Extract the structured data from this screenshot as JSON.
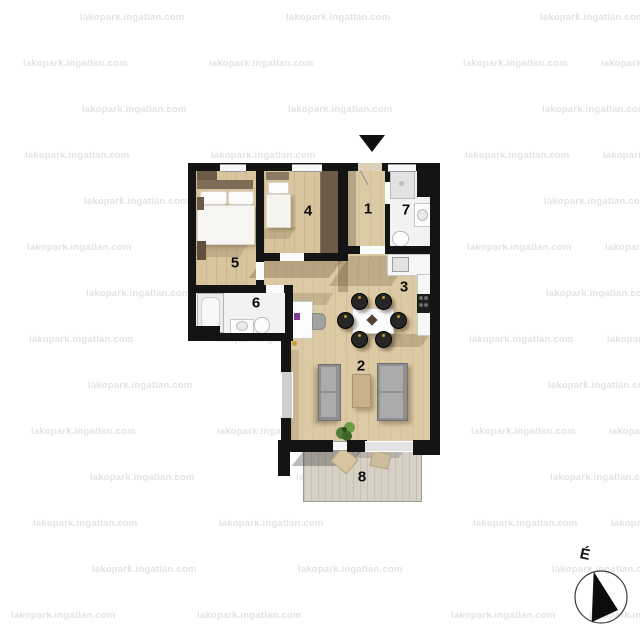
{
  "watermark": {
    "text": "lakopark.ingatlan.com"
  },
  "compass": {
    "north_label": "É"
  },
  "rooms": {
    "r1": {
      "label": "1"
    },
    "r2": {
      "label": "2"
    },
    "r3": {
      "label": "3"
    },
    "r4": {
      "label": "4"
    },
    "r5": {
      "label": "5"
    },
    "r6": {
      "label": "6"
    },
    "r7": {
      "label": "7"
    },
    "r8": {
      "label": "8"
    }
  },
  "palette": {
    "wall": "#141414",
    "wood": "#dccaa4",
    "wood2": "#d8c59e",
    "bath": "#f2f2f2",
    "terrace": "#d7d0c5",
    "sofa": "#8f8f8f",
    "wardrobe": "#6b5b48",
    "gold": "#c59a35"
  }
}
